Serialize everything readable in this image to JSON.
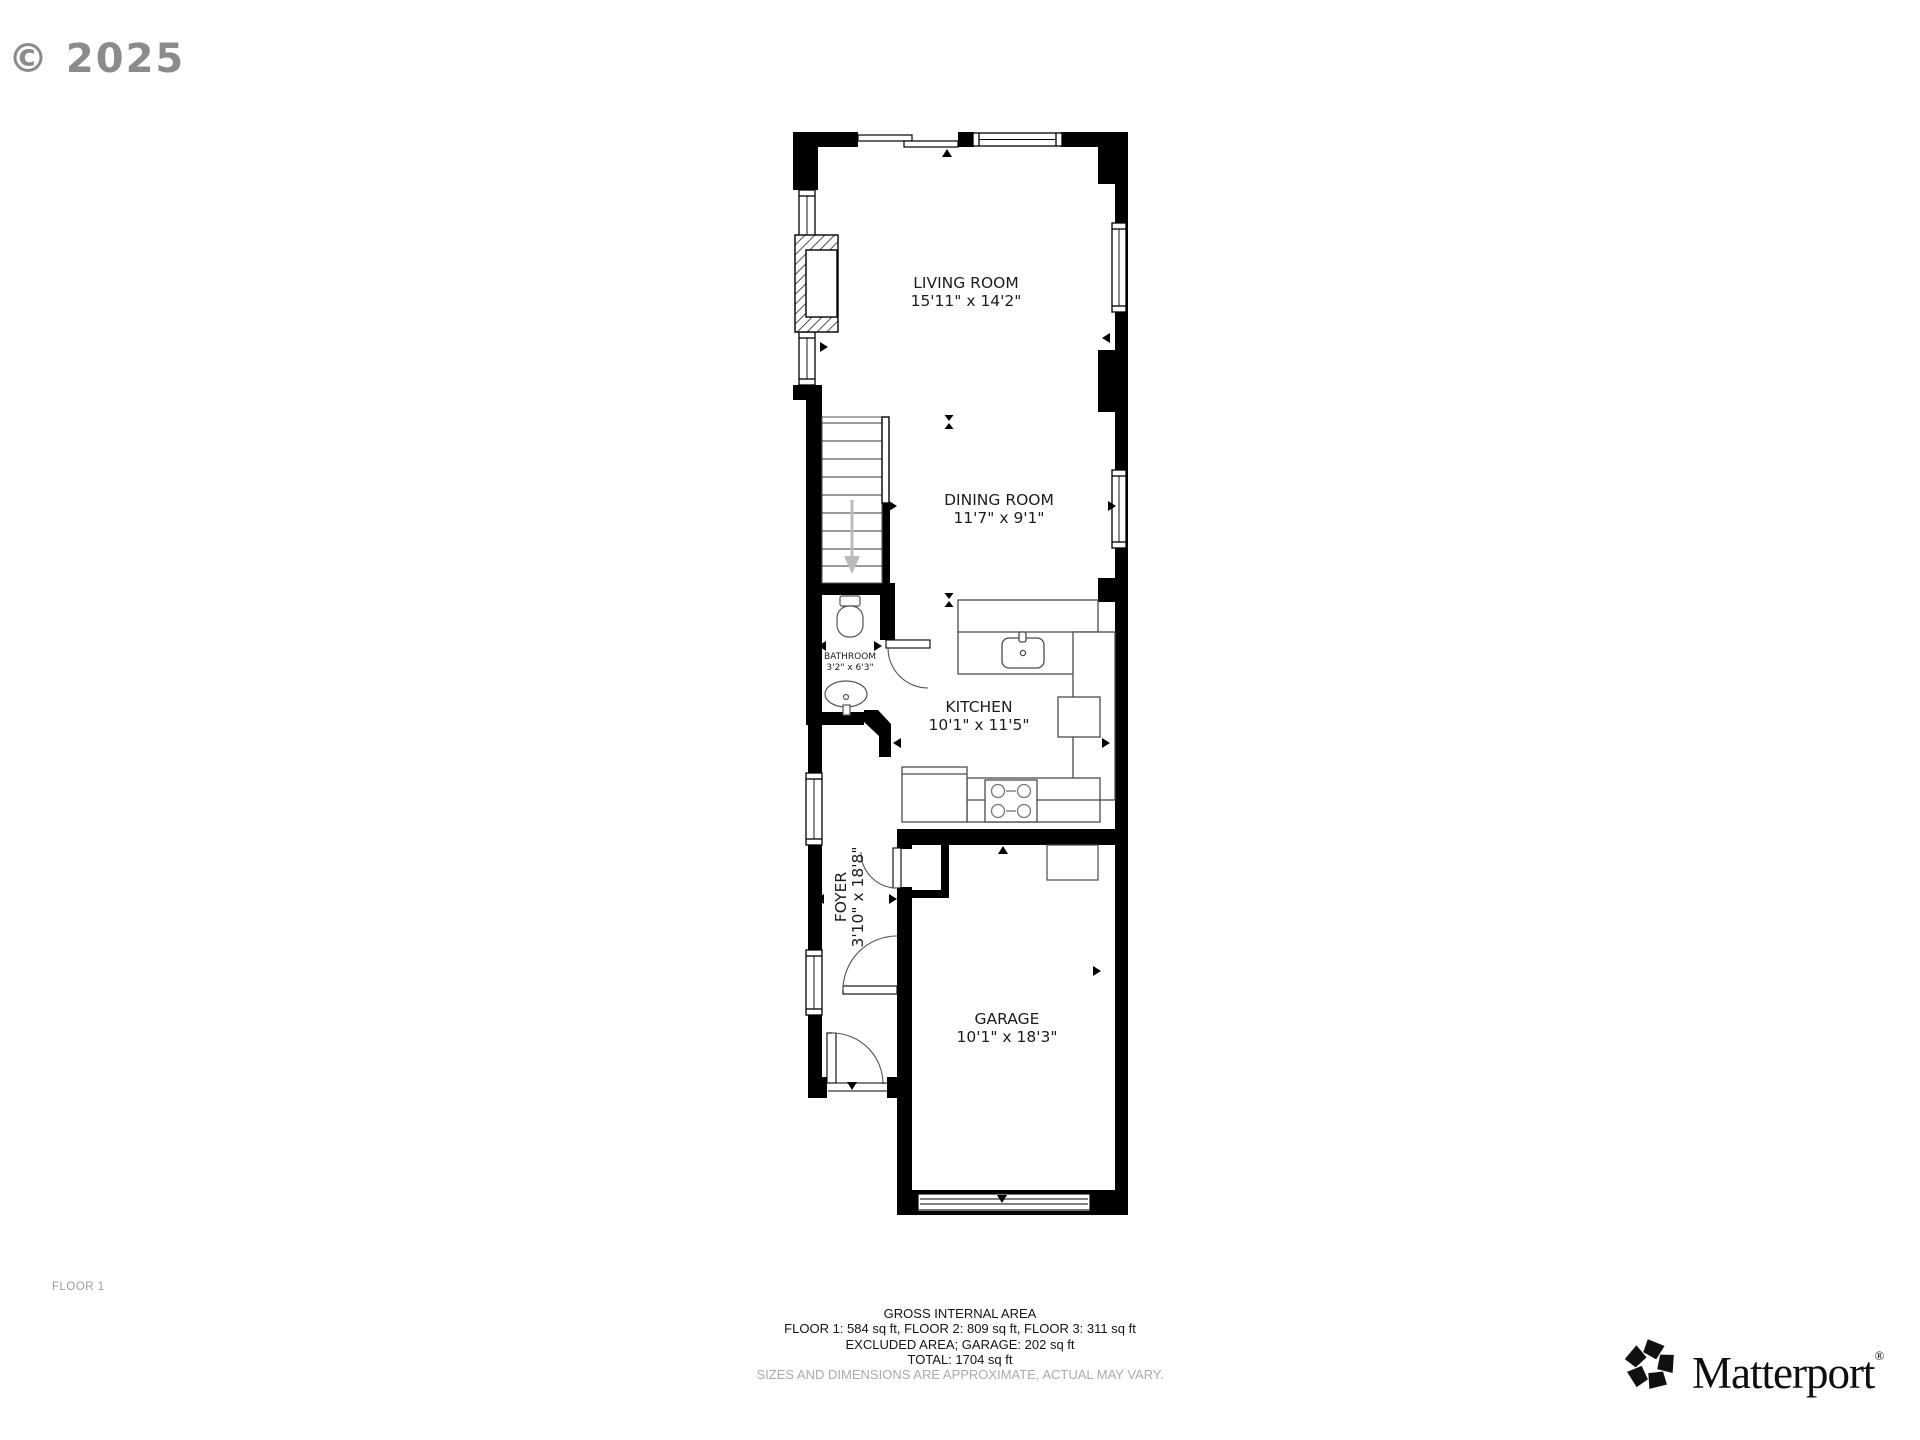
{
  "watermark": "© 2025",
  "floor_label": "FLOOR 1",
  "rooms": {
    "living": {
      "name": "LIVING ROOM",
      "dims": "15'11\" x 14'2\""
    },
    "dining": {
      "name": "DINING ROOM",
      "dims": "11'7\" x 9'1\""
    },
    "bathroom": {
      "name": "BATHROOM",
      "dims": "3'2\" x 6'3\""
    },
    "kitchen": {
      "name": "KITCHEN",
      "dims": "10'1\" x 11'5\""
    },
    "foyer": {
      "name": "FOYER",
      "dims": "3'10\" x 18'8\""
    },
    "garage": {
      "name": "GARAGE",
      "dims": "10'1\" x 18'3\""
    }
  },
  "footer": {
    "title": "GROSS INTERNAL AREA",
    "line1": "FLOOR 1: 584 sq ft, FLOOR 2: 809 sq ft, FLOOR 3: 311 sq ft",
    "line2": "EXCLUDED AREA; GARAGE: 202 sq ft",
    "line3": "TOTAL: 1704 sq ft",
    "disclaimer": "SIZES AND DIMENSIONS ARE APPROXIMATE, ACTUAL MAY VARY."
  },
  "brand": {
    "name": "Matterport",
    "registered": "®"
  },
  "colors": {
    "wall": "#000000",
    "background": "#ffffff",
    "muted": "#9c9c9c",
    "fixture": "#4a4a4a"
  }
}
